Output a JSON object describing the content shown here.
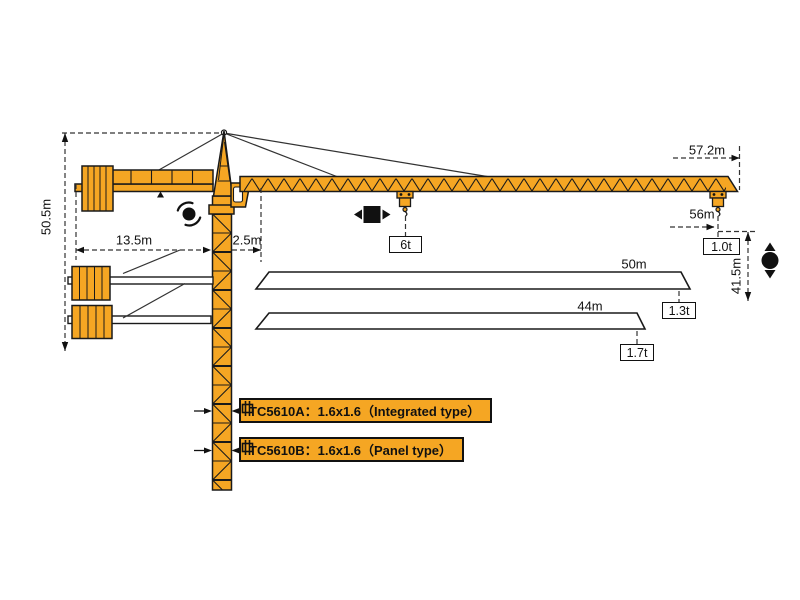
{
  "diagram_title": "TC5610 tower crane working range diagram",
  "dimensions": {
    "total_height": "50.5m",
    "counter_jib_radius": "13.5m",
    "min_radius": "2.5m",
    "max_radius": "57.2m",
    "tip_load_radius": "56m",
    "hook_height": "41.5m",
    "jib_option_long": "50m",
    "jib_option_short": "44m"
  },
  "loads": {
    "mid_jib": "6t",
    "tip_56m": "1.0t",
    "tip_50m": "1.3t",
    "tip_44m": "1.7t"
  },
  "mast_labels": {
    "model_a": "TC5610A：1.6x1.6（Integrated type）",
    "model_b": "TC5610B：1.6x1.6（Panel type）"
  },
  "icons": {
    "slewing": "rotation-slewing",
    "trolley_travel": "trolley-travel-left-right",
    "hoisting": "hook-hoisting-up-down",
    "mast_section": "mast-section"
  },
  "colors": {
    "crane_orange": "#F5A623",
    "outline": "#1A1A1A",
    "dimension_line": "#333333",
    "background": "#FFFFFF"
  }
}
